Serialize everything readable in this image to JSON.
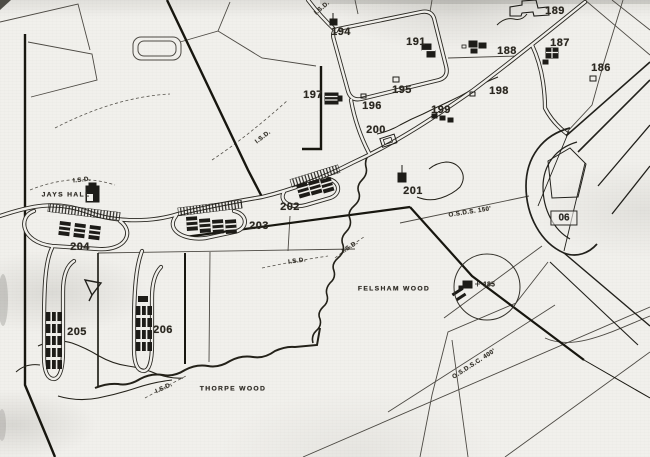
{
  "map": {
    "paper_color": "#f1f0ec",
    "ink_color": "#26241f",
    "site_numbers": [
      {
        "text": "189",
        "x": 555,
        "y": 11
      },
      {
        "text": "187",
        "x": 560,
        "y": 43
      },
      {
        "text": "188",
        "x": 507,
        "y": 51
      },
      {
        "text": "186",
        "x": 601,
        "y": 68
      },
      {
        "text": "191",
        "x": 416,
        "y": 42
      },
      {
        "text": "194",
        "x": 341,
        "y": 32
      },
      {
        "text": "197",
        "x": 313,
        "y": 95
      },
      {
        "text": "195",
        "x": 402,
        "y": 90
      },
      {
        "text": "196",
        "x": 372,
        "y": 106
      },
      {
        "text": "198",
        "x": 499,
        "y": 91
      },
      {
        "text": "199",
        "x": 441,
        "y": 110
      },
      {
        "text": "200",
        "x": 376,
        "y": 130
      },
      {
        "text": "201",
        "x": 413,
        "y": 191
      },
      {
        "text": "202",
        "x": 290,
        "y": 207
      },
      {
        "text": "203",
        "x": 259,
        "y": 226
      },
      {
        "text": "204",
        "x": 80,
        "y": 247
      },
      {
        "text": "205",
        "x": 77,
        "y": 332
      },
      {
        "text": "206",
        "x": 163,
        "y": 330
      },
      {
        "text": "185",
        "x": 489,
        "y": 285,
        "small": true
      }
    ],
    "place_names": [
      {
        "text": "JAYS HALL",
        "x": 66,
        "y": 195
      },
      {
        "text": "FELSHAM WOOD",
        "x": 394,
        "y": 289
      },
      {
        "text": "THORPE WOOD",
        "x": 233,
        "y": 389
      }
    ],
    "annotations": [
      {
        "text": "I.S.D.",
        "x": 322,
        "y": 8,
        "rot": -40
      },
      {
        "text": "I.S.D.",
        "x": 82,
        "y": 180,
        "rot": -6
      },
      {
        "text": "I.S.D.",
        "x": 263,
        "y": 137,
        "rot": -38
      },
      {
        "text": "I.S.D.",
        "x": 297,
        "y": 261,
        "rot": -8
      },
      {
        "text": "I.S.D.",
        "x": 350,
        "y": 247,
        "rot": -33
      },
      {
        "text": "I.S.D.",
        "x": 164,
        "y": 388,
        "rot": -25
      },
      {
        "text": "O.S.D.S. 150'",
        "x": 470,
        "y": 212,
        "rot": -9
      },
      {
        "text": "O.S.D.S.C. 400'",
        "x": 474,
        "y": 364,
        "rot": -33
      }
    ],
    "runway_designator": {
      "text": "06",
      "x": 564,
      "y": 218
    }
  }
}
